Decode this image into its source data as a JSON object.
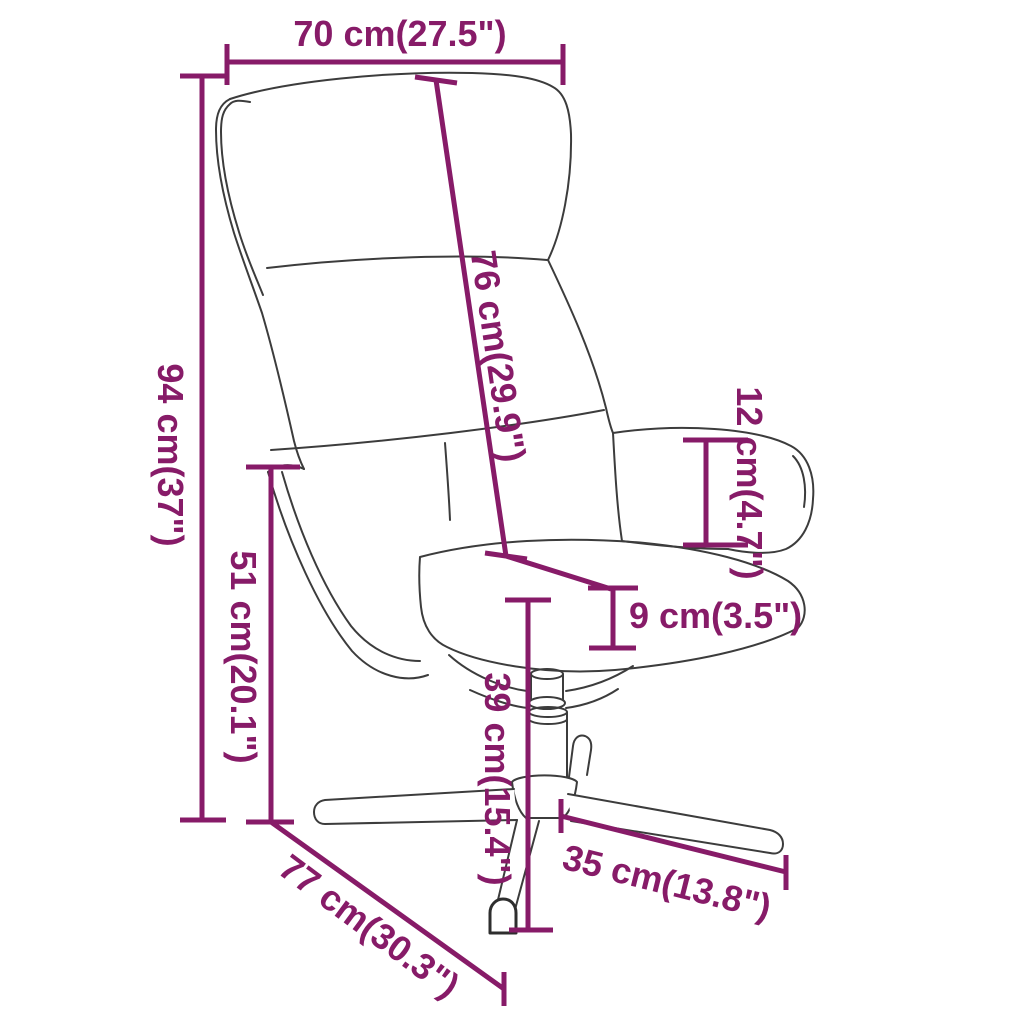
{
  "diagram": {
    "subject": "swivel-relax-chair-dimension-diagram",
    "colors": {
      "dimension_annotation": "#871b68",
      "chair_outline": "#3c3c3c",
      "background": "#ffffff"
    },
    "dimensions": [
      {
        "id": "top-width",
        "cm": 70,
        "inch": 27.5,
        "label": "70 cm(27.5\")"
      },
      {
        "id": "backrest-length",
        "cm": 76,
        "inch": 29.9,
        "label": "76 cm(29.9\")"
      },
      {
        "id": "total-height",
        "cm": 94,
        "inch": 37,
        "label": "94 cm(37\")"
      },
      {
        "id": "seat-height",
        "cm": 51,
        "inch": 20.1,
        "label": "51 cm(20.1\")"
      },
      {
        "id": "armrest-height",
        "cm": 12,
        "inch": 4.7,
        "label": "12 cm(4.7\")"
      },
      {
        "id": "cushion-thickness",
        "cm": 9,
        "inch": 3.5,
        "label": "9 cm(3.5\")"
      },
      {
        "id": "base-height",
        "cm": 39,
        "inch": 15.4,
        "label": "39 cm(15.4\")"
      },
      {
        "id": "base-leg-length",
        "cm": 35,
        "inch": 13.8,
        "label": "35 cm(13.8\")"
      },
      {
        "id": "total-depth",
        "cm": 77,
        "inch": 30.3,
        "label": "77 cm(30.3\")"
      }
    ]
  }
}
